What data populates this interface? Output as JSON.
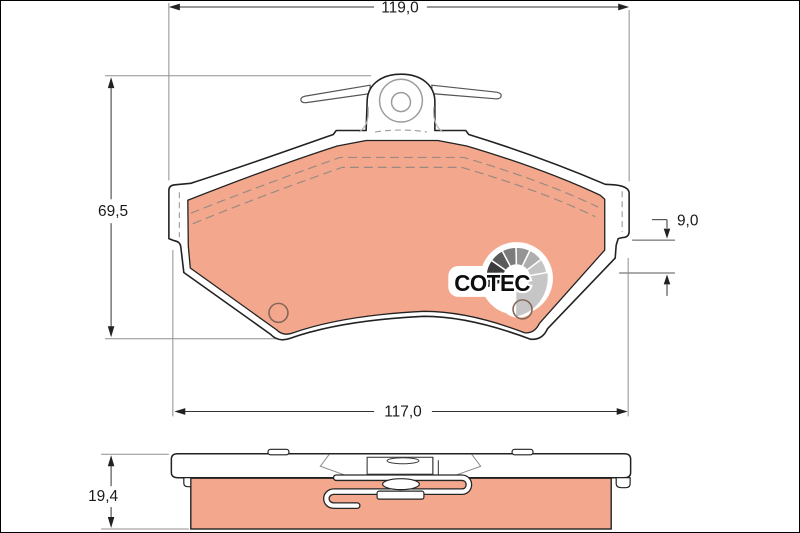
{
  "diagram": {
    "logo": {
      "text": "COTEC",
      "icon": "segmented-fan-gauge-icon"
    },
    "dimensions": {
      "top_width": "119,0",
      "pad_height": "69,5",
      "lug_step": "9,0",
      "bottom_width": "117,0",
      "side_thickness": "19,4"
    },
    "colors": {
      "friction_material": "#f3a88e",
      "outline": "#222222",
      "dimension_text": "#1a1a1a",
      "extension_line": "#8f8f8f",
      "logo_text": "#0d0d0d",
      "logo_dark_segment": "#161616",
      "logo_light_segment": "#c4c4c4",
      "hole_stroke": "#86675a"
    }
  }
}
